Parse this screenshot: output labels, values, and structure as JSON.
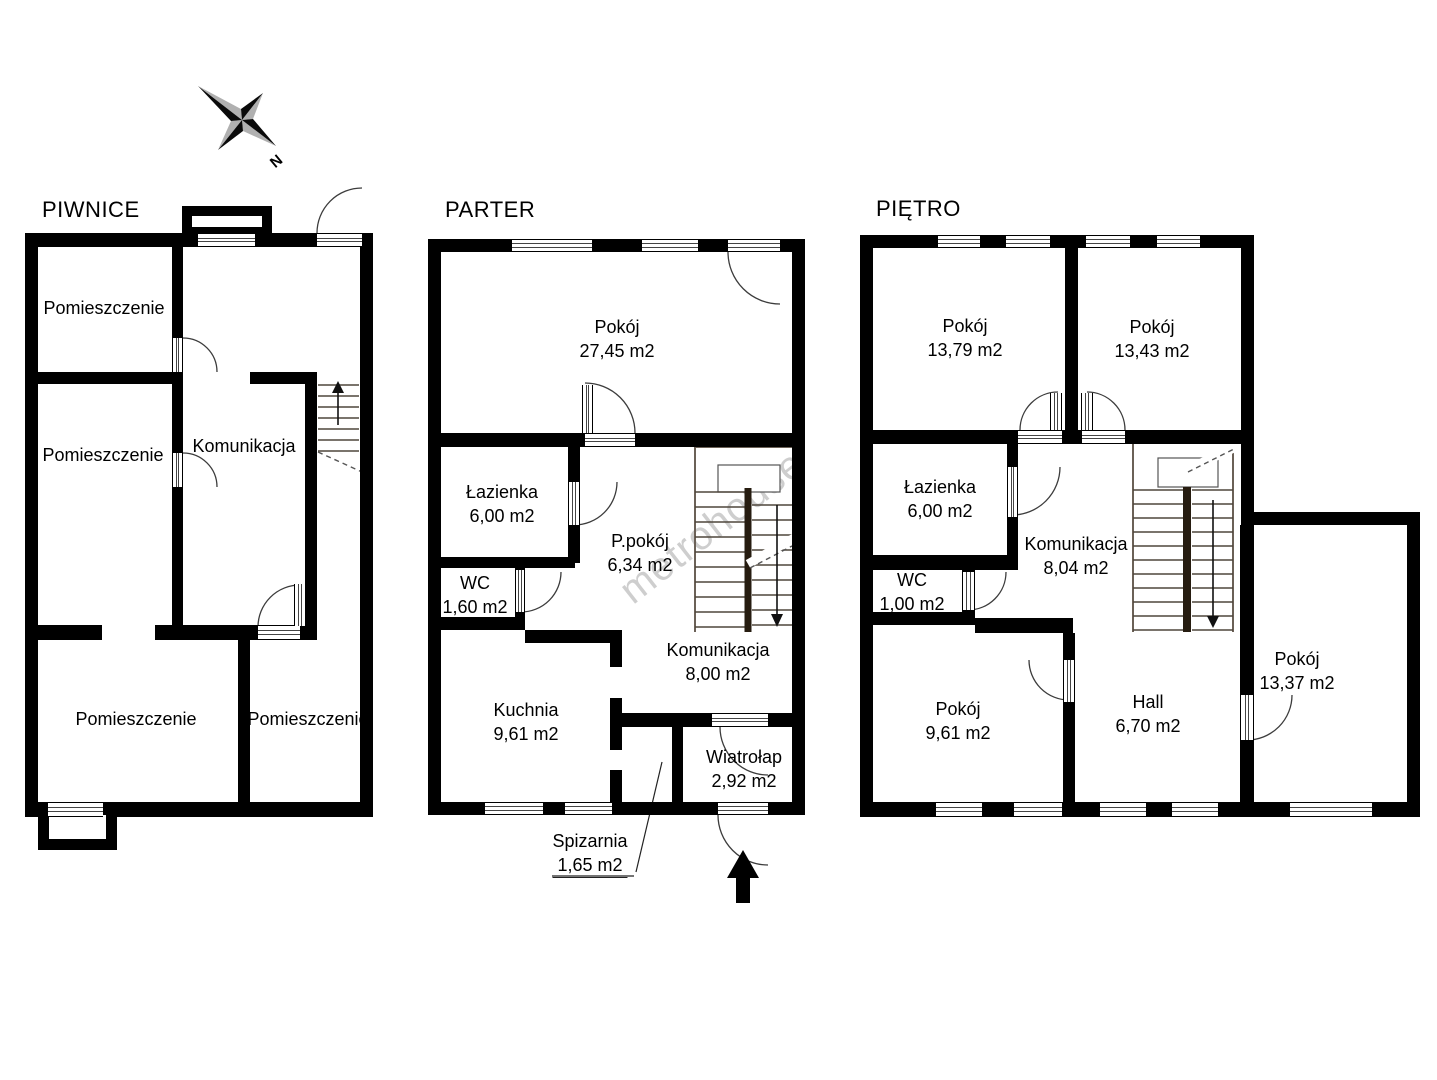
{
  "compass": {
    "north_label": "N"
  },
  "watermark": {
    "text": "metrohouse"
  },
  "floors": [
    {
      "id": "piwnice",
      "title": "PIWNICE",
      "rooms": [
        {
          "name": "Pomieszczenie",
          "area": ""
        },
        {
          "name": "Pomieszczenie",
          "area": ""
        },
        {
          "name": "Komunikacja",
          "area": ""
        },
        {
          "name": "Pomieszczenie",
          "area": ""
        },
        {
          "name": "Pomieszczenie",
          "area": ""
        }
      ]
    },
    {
      "id": "parter",
      "title": "PARTER",
      "rooms": [
        {
          "name": "Pokój",
          "area": "27,45 m2"
        },
        {
          "name": "Łazienka",
          "area": "6,00 m2"
        },
        {
          "name": "WC",
          "area": "1,60 m2"
        },
        {
          "name": "P.pokój",
          "area": "6,34 m2"
        },
        {
          "name": "Kuchnia",
          "area": "9,61 m2"
        },
        {
          "name": "Komunikacja",
          "area": "8,00 m2"
        },
        {
          "name": "Wiatrołap",
          "area": "2,92 m2"
        },
        {
          "name": "Spizarnia",
          "area": "1,65 m2"
        }
      ]
    },
    {
      "id": "pietro",
      "title": "PIĘTRO",
      "rooms": [
        {
          "name": "Pokój",
          "area": "13,79 m2"
        },
        {
          "name": "Pokój",
          "area": "13,43 m2"
        },
        {
          "name": "Łazienka",
          "area": "6,00 m2"
        },
        {
          "name": "WC",
          "area": "1,00 m2"
        },
        {
          "name": "Komunikacja",
          "area": "8,04 m2"
        },
        {
          "name": "Pokój",
          "area": "9,61 m2"
        },
        {
          "name": "Hall",
          "area": "6,70 m2"
        },
        {
          "name": "Pokój",
          "area": "13,37 m2"
        }
      ]
    }
  ]
}
